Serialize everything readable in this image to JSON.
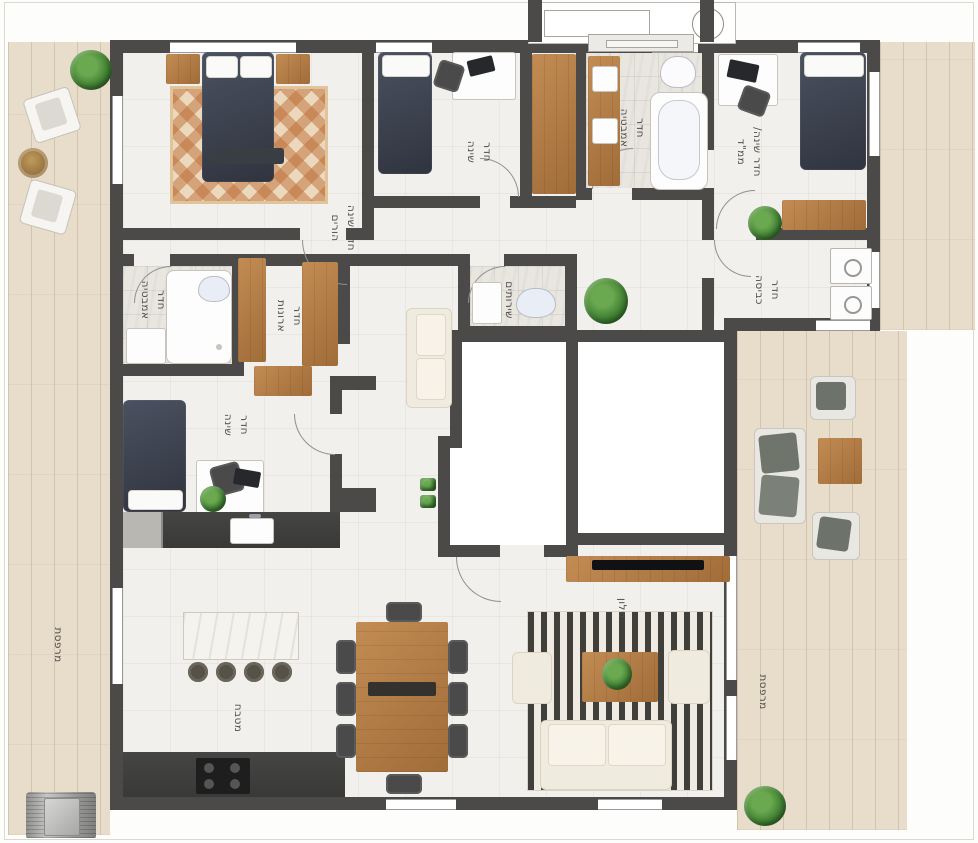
{
  "plan_title": "apartment floor plan",
  "colors": {
    "wall": "#4b4a48",
    "furniture_wood": "#b5834a",
    "balcony_wood": "#e7ddca",
    "bed_fabric": "#3c4250",
    "plant_green": "#3e7d31",
    "floor_tile": "#f2f0ec"
  },
  "rooms": {
    "master_bedroom": {
      "line1": "חדר שינה",
      "line2": "הורים"
    },
    "bedroom2": {
      "line1": "חדר",
      "line2": "שינה"
    },
    "bathroom_top": {
      "line1": "חדר",
      "line2": "אמבטיה"
    },
    "safe_room": {
      "line1": "חדר שינה/",
      "line2": "ממ\"ד"
    },
    "laundry": {
      "line1": "חדר",
      "line2": "כביסה"
    },
    "bathroom_left": {
      "line1": "חדר",
      "line2": "אמבטיה"
    },
    "closet_room": {
      "line1": "חדר",
      "line2": "ארונות"
    },
    "wc": {
      "line1": "שירותים",
      "line2": ""
    },
    "bedroom3": {
      "line1": "חדר",
      "line2": "שינה"
    },
    "kitchen": {
      "line1": "מטבח",
      "line2": ""
    },
    "living_room": {
      "line1": "סלון",
      "line2": ""
    },
    "balcony_left": {
      "line1": "מרפסת",
      "line2": ""
    },
    "balcony_right": {
      "line1": "מרפסת",
      "line2": ""
    }
  }
}
